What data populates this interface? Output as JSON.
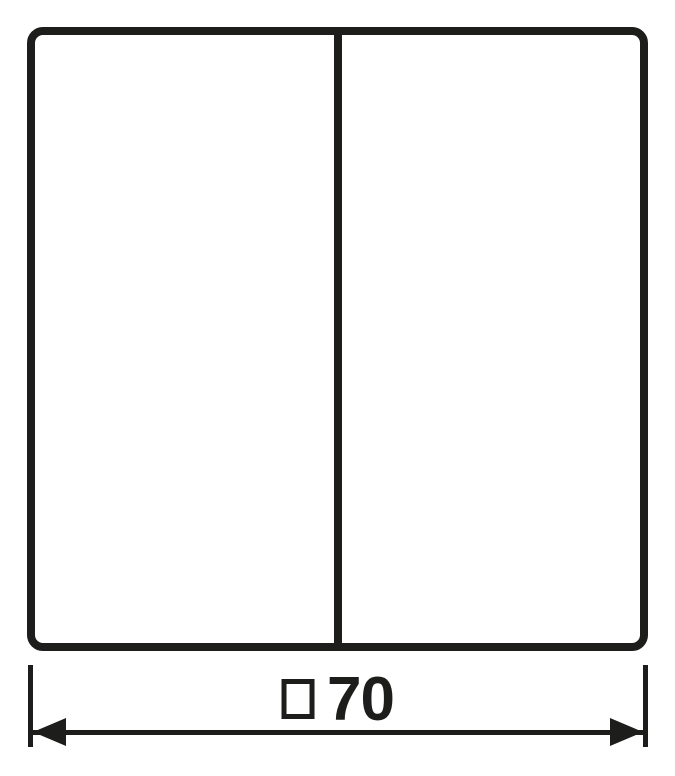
{
  "drawing": {
    "type": "technical-dimension-drawing",
    "subject": "two-gang-switch-rocker-plate",
    "colors": {
      "line": "#1d1d1b",
      "background": "#ffffff"
    },
    "dimension": {
      "symbol": "square",
      "value": "70",
      "full_label": "□70"
    }
  }
}
